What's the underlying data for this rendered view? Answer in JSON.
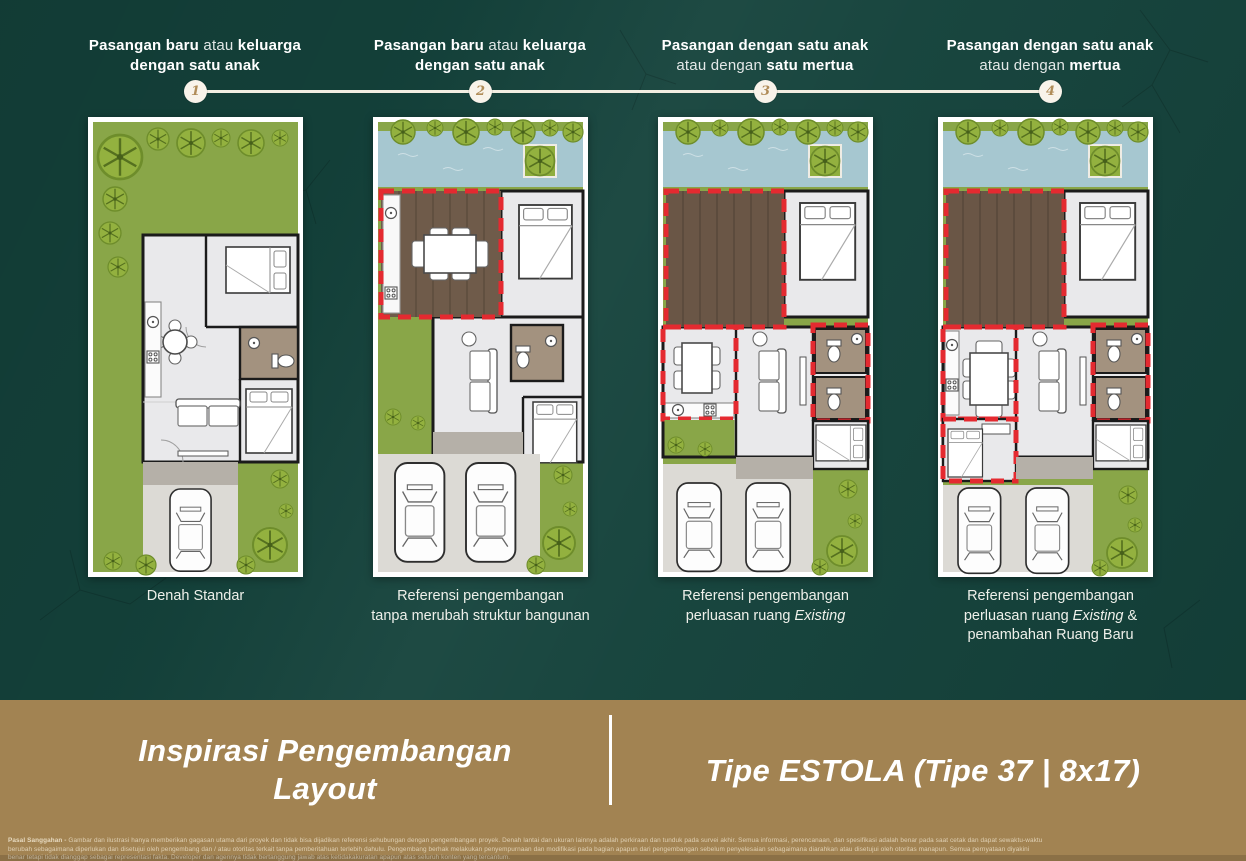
{
  "colors": {
    "background_teal": "#14423b",
    "footer_tan": "#a28352",
    "accent_red": "#e42a30",
    "lawn_green": "#89a648",
    "pool_blue": "#a6c7d0",
    "deck_brown": "#6f5b4a",
    "circle_cream": "#f8f3ea",
    "number_gold": "#b08c58"
  },
  "steps": [
    {
      "number": "1",
      "title_lines": [
        [
          {
            "text": "Pasangan baru ",
            "bold": true
          },
          {
            "text": "atau ",
            "bold": false
          },
          {
            "text": "keluarga",
            "bold": true
          }
        ],
        [
          {
            "text": "dengan satu anak",
            "bold": true
          }
        ]
      ],
      "caption_lines": [
        [
          {
            "text": "Denah Standar"
          }
        ]
      ]
    },
    {
      "number": "2",
      "title_lines": [
        [
          {
            "text": "Pasangan baru ",
            "bold": true
          },
          {
            "text": "atau ",
            "bold": false
          },
          {
            "text": "keluarga",
            "bold": true
          }
        ],
        [
          {
            "text": "dengan satu anak",
            "bold": true
          }
        ]
      ],
      "caption_lines": [
        [
          {
            "text": "Referensi pengembangan"
          }
        ],
        [
          {
            "text": "tanpa merubah struktur bangunan"
          }
        ]
      ]
    },
    {
      "number": "3",
      "title_lines": [
        [
          {
            "text": "Pasangan dengan satu anak",
            "bold": true
          }
        ],
        [
          {
            "text": "atau dengan ",
            "bold": false
          },
          {
            "text": "satu mertua",
            "bold": true
          }
        ]
      ],
      "caption_lines": [
        [
          {
            "text": "Referensi pengembangan"
          }
        ],
        [
          {
            "text": "perluasan ruang "
          },
          {
            "text": "Existing",
            "italic": true
          }
        ]
      ]
    },
    {
      "number": "4",
      "title_lines": [
        [
          {
            "text": "Pasangan dengan satu anak",
            "bold": true
          }
        ],
        [
          {
            "text": "atau dengan ",
            "bold": false
          },
          {
            "text": "mertua",
            "bold": true
          }
        ]
      ],
      "caption_lines": [
        [
          {
            "text": "Referensi pengembangan"
          }
        ],
        [
          {
            "text": "perluasan ruang "
          },
          {
            "text": "Existing",
            "italic": true
          },
          {
            "text": " &"
          }
        ],
        [
          {
            "text": "penambahan Ruang Baru"
          }
        ]
      ]
    }
  ],
  "footer": {
    "left_title_line1": "Inspirasi Pengembangan",
    "left_title_line2": "Layout",
    "right_title": "Tipe ESTOLA (Tipe 37 | 8x17)",
    "disclaimer_lines": [
      [
        {
          "text": "Pasal Sanggahan - ",
          "bold": true
        },
        {
          "text": "Gambar dan ilustrasi hanya memberikan gagasan utama dari proyek dan tidak bisa dijadikan referensi sehubungan dengan pengembangan proyek. Denah lantai dan ukuran lainnya adalah perkiraan dan tunduk pada survei akhir. Semua informasi, perencanaan, dan spesifikasi adalah benar pada saat cetak dan dapat sewaktu-waktu"
        }
      ],
      [
        {
          "text": "berubah sebagaimana diperlukan dan disetujui oleh pengembang dan / atau otoritas terkait tanpa pemberitahuan terlebih dahulu. Pengembang berhak melakukan penyempurnaan dan modifikasi pada bagian apapun dari pengembangan sebelum penyelesaian sebagaimana diarahkan atau disetujui oleh otoritas manapun. Semua pernyataan diyakini"
        }
      ],
      [
        {
          "text": "benar tetapi tidak dianggap sebagai representasi fakta. Developer dan agennya tidak bertanggung jawab atas ketidakakuratan apapun atas seluruh konten yang tercantum."
        }
      ]
    ]
  }
}
